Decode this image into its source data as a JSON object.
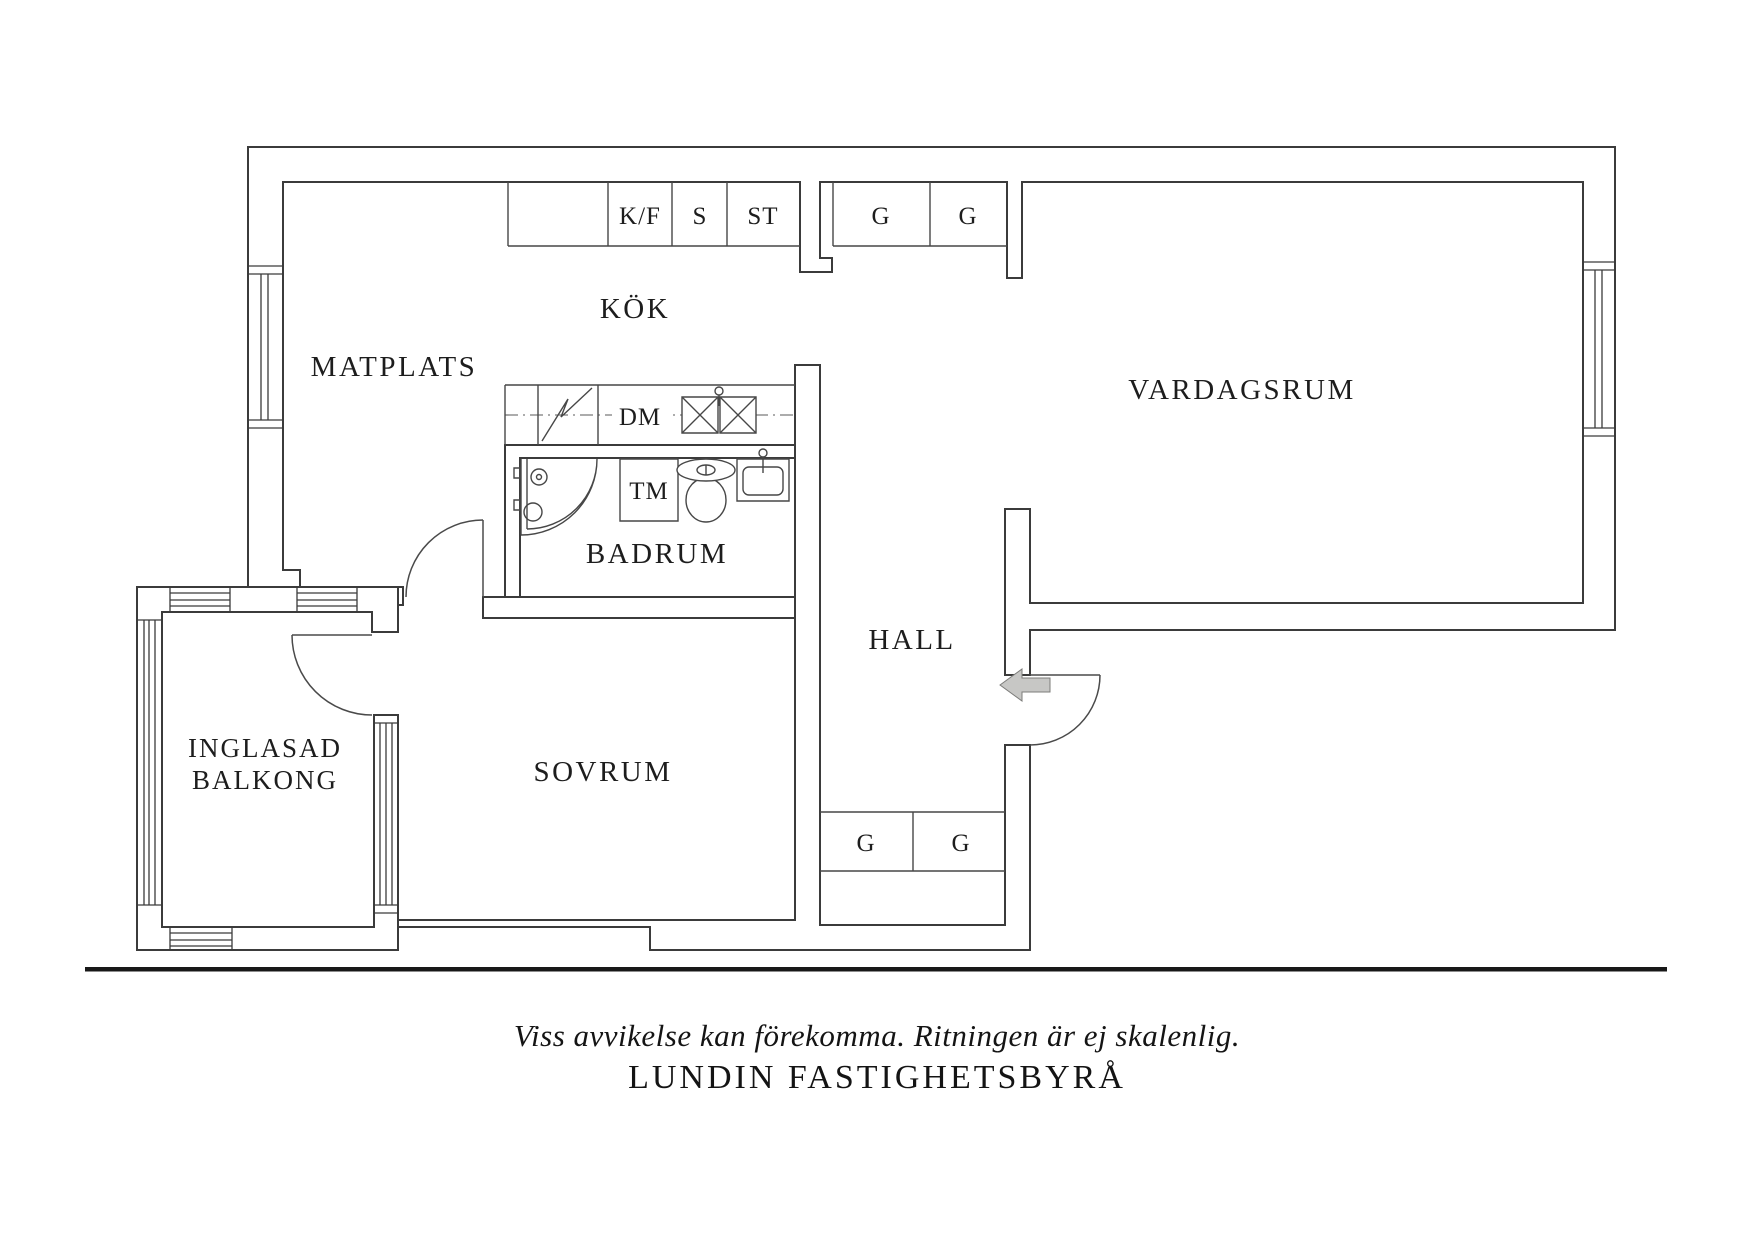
{
  "floor_plan": {
    "rooms": {
      "dining": "MATPLATS",
      "kitchen": "KÖK",
      "living_room": "VARDAGSRUM",
      "bathroom": "BADRUM",
      "hall": "HALL",
      "bedroom": "SOVRUM",
      "balcony_line1": "INGLASAD",
      "balcony_line2": "BALKONG"
    },
    "labels": {
      "fridge_freezer": "K/F",
      "pantry": "S",
      "cleaning_closet": "ST",
      "wardrobe_top_1": "G",
      "wardrobe_top_2": "G",
      "dishwasher": "DM",
      "washing_machine": "TM",
      "wardrobe_hall_1": "G",
      "wardrobe_hall_2": "G"
    }
  },
  "footer": {
    "disclaimer": "Viss avvikelse kan förekomma. Ritningen är ej skalenlig.",
    "brand": "LUNDIN FASTIGHETSBYRÅ"
  },
  "colors": {
    "wall_line": "#3b3b3b",
    "fixture_line": "#474747",
    "text": "#1d1d1d",
    "entry_arrow_fill": "#c7c7c5",
    "entry_arrow_stroke": "#7c7c7a",
    "ground_line": "#181818"
  }
}
